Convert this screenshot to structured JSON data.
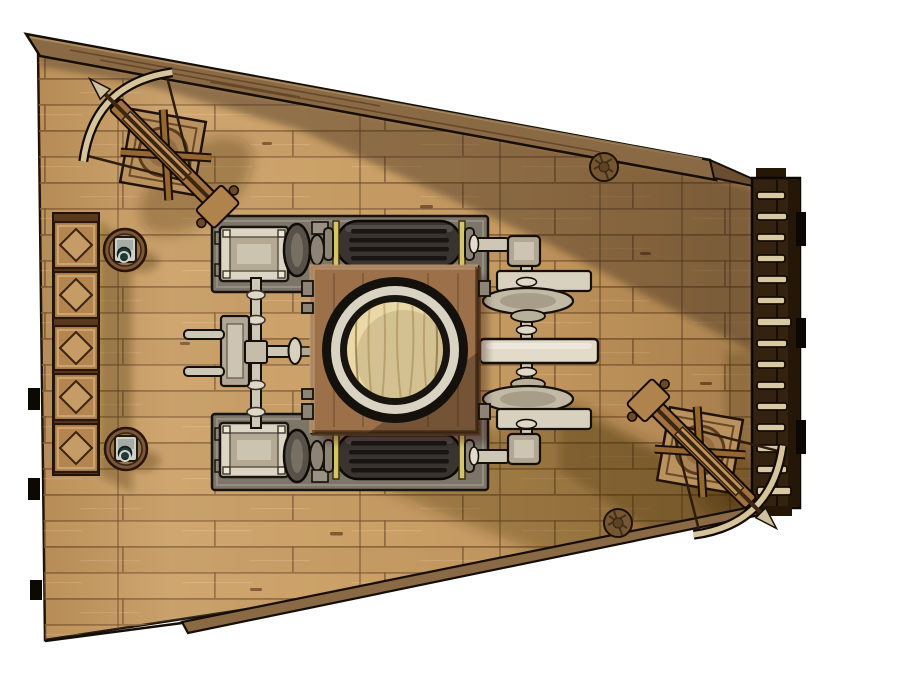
{
  "scene": {
    "kind": "top-down-battlemap-token",
    "subject": "wooden airship deck section with steam machinery"
  },
  "palette": {
    "background": "#ffffff",
    "deck_wood": "#c79b60",
    "plank_seam": "#8a6239",
    "rail_wood": "#8a6a44",
    "rail_edge_dark": "#150d06",
    "ladder_board": "#33220f",
    "ladder_rung": "#d8c8a4",
    "crate_frame": "#58391d",
    "crate_face": "#b5854f",
    "crate_diamond": "#c59b66",
    "platform_wood": "#9c714a",
    "hatch_lid_wood": "#ead9a6",
    "hatch_ring_silver": "#d9d3c4",
    "tank_body": "#39342f",
    "brass_ring": "#d6c468",
    "metal_light": "#ddd5c3",
    "metal_mid": "#b1a794",
    "baseplate_gray": "#7d7568",
    "rope_coil": "#775732",
    "turret_platform": "#b9925e",
    "shadow_tint": "rgba(58,38,18,0.40)"
  },
  "objects": {
    "ballista_count": 2,
    "crate_count": 5,
    "ring_pull_hatch_count": 2,
    "rope_coil_count": 2,
    "ladder_rung_count": 15,
    "steam_tank_count": 2,
    "piston_block_count": 2
  }
}
